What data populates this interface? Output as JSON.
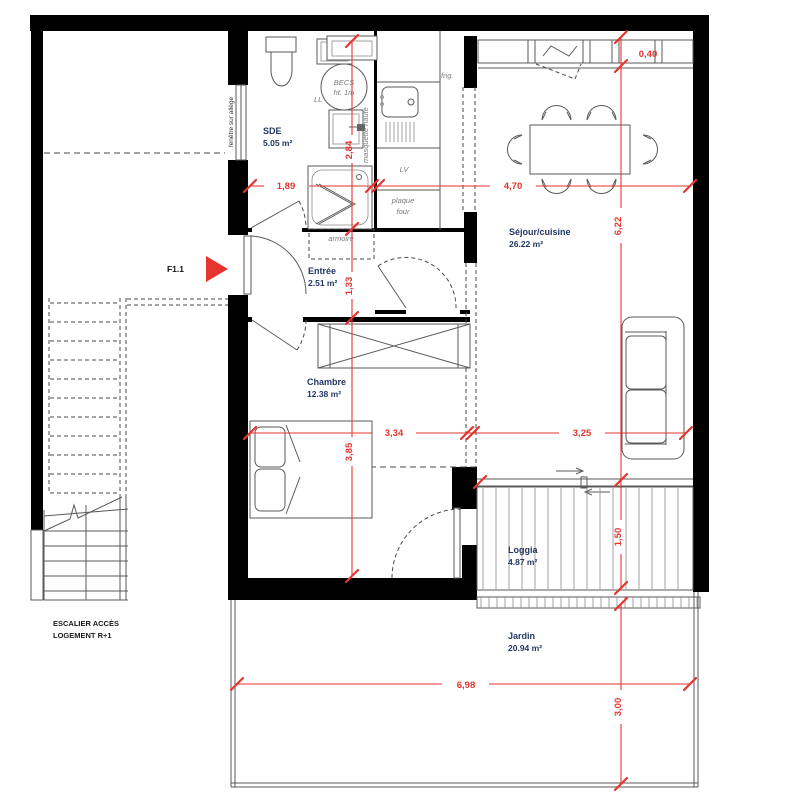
{
  "plan": {
    "unit_label": "F1.1",
    "rooms": [
      {
        "name": "SDE",
        "area": "5.05 m²"
      },
      {
        "name": "Entrée",
        "area": "2.51 m²"
      },
      {
        "name": "Chambre",
        "area": "12.38 m²"
      },
      {
        "name": "Séjour/cuisine",
        "area": "26.22 m²"
      },
      {
        "name": "Loggia",
        "area": "4.87 m²"
      },
      {
        "name": "Jardin",
        "area": "20.94 m²"
      }
    ],
    "fixtures": {
      "water_heater_l1": "BECS",
      "water_heater_l2": "ht. 1m",
      "washing_machine": "LL",
      "fridge": "frig.",
      "dishwasher": "LV",
      "cooktop_l1": "plaque",
      "cooktop_l2": "four",
      "wardrobe": "armoire",
      "high_unit": "masquette haute",
      "window_note": "fenêtre sur allège"
    },
    "stair": {
      "l1": "ESCALIER ACCÈS",
      "l2": "LOGEMENT R+1"
    },
    "dimensions": {
      "sde_width": "1,89",
      "sde_depth": "2,84",
      "sejour_width": "4,70",
      "ledge_depth": "0,40",
      "sejour_depth": "6,22",
      "entree_depth": "1,33",
      "chambre_width": "3,34",
      "sejour_lower_width": "3,25",
      "chambre_depth": "3,85",
      "loggia_depth": "1,50",
      "jardin_width": "6,98",
      "jardin_depth": "3,00"
    }
  },
  "colors": {
    "wall": "#000000",
    "dimension_red": "#e5352f",
    "room_label": "#223764",
    "fixture_label": "#7a7a7a",
    "furniture_line": "#5a5a5a"
  }
}
